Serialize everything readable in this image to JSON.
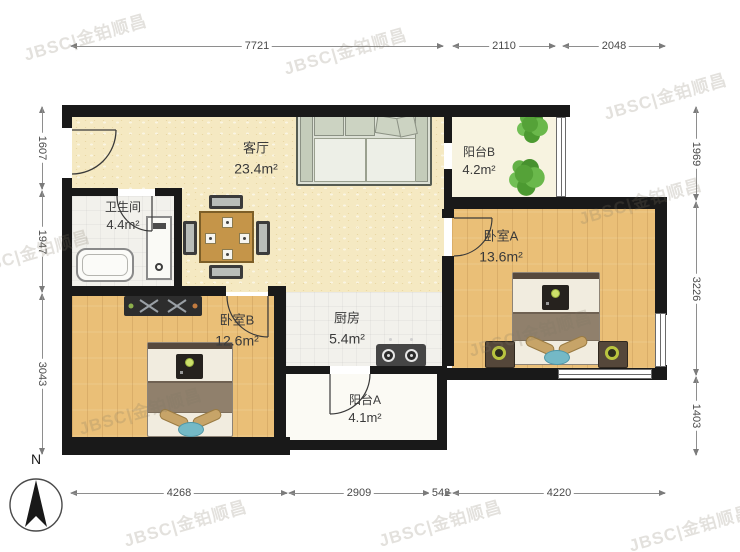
{
  "watermark": {
    "text": "JBSC|金铂顺昌"
  },
  "compass": {
    "label": "N"
  },
  "rooms": {
    "living": {
      "name": "客厅",
      "area": "23.4m²"
    },
    "bathroom": {
      "name": "卫生间",
      "area": "4.4m²"
    },
    "balcony_b": {
      "name": "阳台B",
      "area": "4.2m²"
    },
    "bedroom_a": {
      "name": "卧室A",
      "area": "13.6m²"
    },
    "bedroom_b": {
      "name": "卧室B",
      "area": "12.6m²"
    },
    "kitchen": {
      "name": "厨房",
      "area": "5.4m²"
    },
    "balcony_a": {
      "name": "阳台A",
      "area": "4.1m²"
    }
  },
  "dimensions": {
    "top": [
      {
        "value": "7721"
      },
      {
        "value": "2110"
      },
      {
        "value": "2048"
      }
    ],
    "bottom": [
      {
        "value": "4268"
      },
      {
        "value": "2909"
      },
      {
        "value": "542"
      },
      {
        "value": "4220"
      }
    ],
    "left": [
      {
        "value": "1607"
      },
      {
        "value": "1947"
      },
      {
        "value": "3043"
      }
    ],
    "right": [
      {
        "value": "1969"
      },
      {
        "value": "3226"
      },
      {
        "value": "1403"
      }
    ]
  },
  "colors": {
    "wall": "#191919",
    "living_floor": "#f5e9c2",
    "wood_floor": "#eabf77",
    "balcony_floor": "#f7f3e0",
    "tile_floor": "#f2f1ec",
    "accent_teal": "#74b9c6",
    "plant_green": "#55a238",
    "lamp_olive": "#b9c43f",
    "dimension_gray": "#8e8e8e"
  }
}
